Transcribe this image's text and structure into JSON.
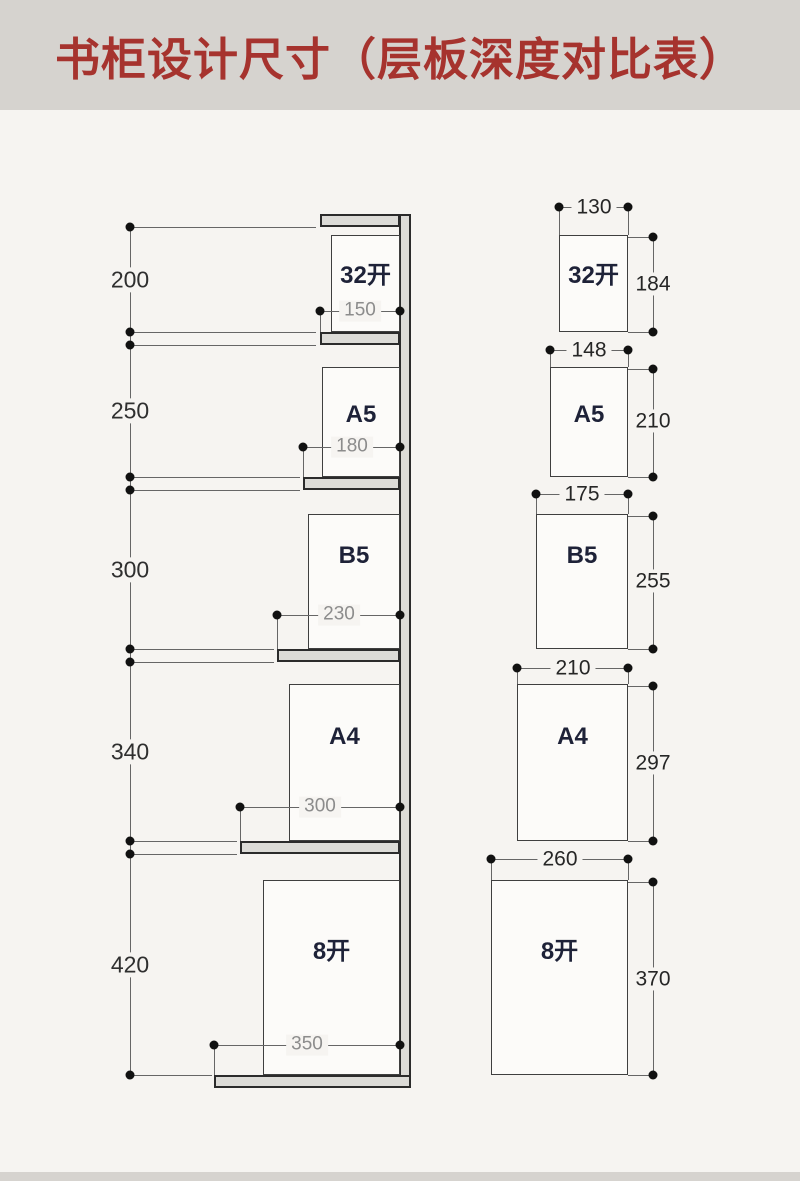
{
  "title": "书柜设计尺寸（层板深度对比表）",
  "colors": {
    "title_red": "#a6332e",
    "band_gray": "#d6d3cf",
    "board_fill": "#dcdbd7",
    "line_gray": "#666666"
  },
  "sizes": [
    {
      "name": "32开",
      "shelf_height": "200",
      "shelf_depth": "150",
      "book_width": "130",
      "book_height": "184"
    },
    {
      "name": "A5",
      "shelf_height": "250",
      "shelf_depth": "180",
      "book_width": "148",
      "book_height": "210"
    },
    {
      "name": "B5",
      "shelf_height": "300",
      "shelf_depth": "230",
      "book_width": "175",
      "book_height": "255"
    },
    {
      "name": "A4",
      "shelf_height": "340",
      "shelf_depth": "300",
      "book_width": "210",
      "book_height": "297"
    },
    {
      "name": "8开",
      "shelf_height": "420",
      "shelf_depth": "350",
      "book_width": "260",
      "book_height": "370"
    }
  ]
}
